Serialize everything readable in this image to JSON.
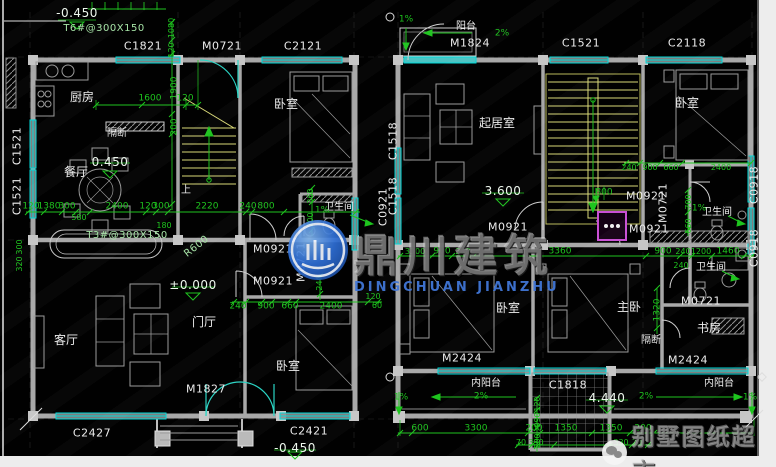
{
  "colors": {
    "dim_green": "#1ec41e",
    "window_cyan": "#00d9d9",
    "wall_gray": "#a8a8a8",
    "stair_yellow": "#d9d978",
    "shower_magenta": "#c94fd4",
    "watermark_blue": "#2f6fd6"
  },
  "watermarks": {
    "center_cn": "鼎川建筑",
    "center_en": "DINGCHUAN JIANZHU",
    "corner": "别墅图纸超市"
  },
  "labels": {
    "tags": [
      {
        "t": "C1821",
        "x": 143,
        "y": 46
      },
      {
        "t": "M0721",
        "x": 222,
        "y": 46
      },
      {
        "t": "C2121",
        "x": 303,
        "y": 46
      },
      {
        "t": "M1824",
        "x": 470,
        "y": 43
      },
      {
        "t": "C1521",
        "x": 581,
        "y": 43
      },
      {
        "t": "C2118",
        "x": 687,
        "y": 43
      },
      {
        "t": "C1521",
        "x": 17,
        "y": 146,
        "r": -90
      },
      {
        "t": "C1521",
        "x": 17,
        "y": 196,
        "r": -90
      },
      {
        "t": "C0921",
        "x": 383,
        "y": 207,
        "r": -90
      },
      {
        "t": "C1518",
        "x": 393,
        "y": 141,
        "r": -90
      },
      {
        "t": "C1518",
        "x": 393,
        "y": 196,
        "r": -90
      },
      {
        "t": "C0918",
        "x": 754,
        "y": 185,
        "r": -90
      },
      {
        "t": "C0918",
        "x": 754,
        "y": 248,
        "r": -90
      },
      {
        "t": "M0921",
        "x": 273,
        "y": 249
      },
      {
        "t": "M0921",
        "x": 273,
        "y": 281
      },
      {
        "t": "M0721",
        "x": 301,
        "y": 262,
        "r": -90
      },
      {
        "t": "M0921",
        "x": 508,
        "y": 227
      },
      {
        "t": "M0921",
        "x": 646,
        "y": 196
      },
      {
        "t": "M0921",
        "x": 649,
        "y": 229
      },
      {
        "t": "M0721",
        "x": 663,
        "y": 203,
        "r": -90
      },
      {
        "t": "M0721",
        "x": 701,
        "y": 301
      },
      {
        "t": "M1827",
        "x": 206,
        "y": 389
      },
      {
        "t": "C2427",
        "x": 92,
        "y": 433
      },
      {
        "t": "C2421",
        "x": 309,
        "y": 431
      },
      {
        "t": "M2424",
        "x": 462,
        "y": 358
      },
      {
        "t": "M2424",
        "x": 688,
        "y": 360
      },
      {
        "t": "C1818",
        "x": 568,
        "y": 385
      }
    ],
    "rooms": [
      {
        "t": "厨房",
        "x": 82,
        "y": 97
      },
      {
        "t": "隔断",
        "x": 117,
        "y": 134,
        "fs": 10
      },
      {
        "t": "餐厅",
        "x": 76,
        "y": 172
      },
      {
        "t": "卧室",
        "x": 286,
        "y": 104
      },
      {
        "t": "卫生间",
        "x": 339,
        "y": 208,
        "fs": 10
      },
      {
        "t": "客厅",
        "x": 66,
        "y": 340
      },
      {
        "t": "门厅",
        "x": 204,
        "y": 322
      },
      {
        "t": "卧室",
        "x": 288,
        "y": 366
      },
      {
        "t": "上",
        "x": 186,
        "y": 191,
        "fs": 10
      },
      {
        "t": "阳台",
        "x": 466,
        "y": 27,
        "fs": 10
      },
      {
        "t": "起居室",
        "x": 497,
        "y": 123
      },
      {
        "t": "卧室",
        "x": 687,
        "y": 103
      },
      {
        "t": "卫生间",
        "x": 717,
        "y": 213,
        "fs": 10
      },
      {
        "t": "卫生间",
        "x": 711,
        "y": 268,
        "fs": 10
      },
      {
        "t": "卧室",
        "x": 508,
        "y": 308
      },
      {
        "t": "主卧",
        "x": 629,
        "y": 307
      },
      {
        "t": "书房",
        "x": 709,
        "y": 328
      },
      {
        "t": "隔断",
        "x": 651,
        "y": 341,
        "fs": 10
      },
      {
        "t": "内阳台",
        "x": 486,
        "y": 384,
        "fs": 10
      },
      {
        "t": "内阳台",
        "x": 719,
        "y": 384,
        "fs": 10
      }
    ],
    "elevations": [
      {
        "t": "-0.450",
        "x": 77,
        "y": 13
      },
      {
        "t": "0.450",
        "x": 110,
        "y": 162
      },
      {
        "t": "±0.000",
        "x": 193,
        "y": 285
      },
      {
        "t": "3.600",
        "x": 503,
        "y": 191
      },
      {
        "t": "4.440",
        "x": 607,
        "y": 398
      },
      {
        "t": "-0.450",
        "x": 295,
        "y": 448
      }
    ],
    "notes": [
      {
        "t": "T6#@300X150",
        "x": 104,
        "y": 29
      },
      {
        "t": "T3#@300X150",
        "x": 127,
        "y": 236
      },
      {
        "t": "R600",
        "x": 197,
        "y": 247,
        "r": -38
      }
    ],
    "dims": [
      {
        "t": "1600",
        "x": 150,
        "y": 99
      },
      {
        "t": "120",
        "x": 185,
        "y": 99
      },
      {
        "t": "1080",
        "x": 172,
        "y": 28,
        "r": -90,
        "fs": 8
      },
      {
        "t": "120",
        "x": 172,
        "y": 50,
        "r": -90,
        "fs": 8
      },
      {
        "t": "1900",
        "x": 175,
        "y": 88,
        "r": -90
      },
      {
        "t": "200",
        "x": 175,
        "y": 127,
        "r": -90
      },
      {
        "t": "120",
        "x": 31,
        "y": 207
      },
      {
        "t": "1380",
        "x": 49,
        "y": 207
      },
      {
        "t": "300",
        "x": 67,
        "y": 207
      },
      {
        "t": "580",
        "x": 79,
        "y": 218,
        "fs": 8
      },
      {
        "t": "2400",
        "x": 117,
        "y": 207
      },
      {
        "t": "120",
        "x": 148,
        "y": 207
      },
      {
        "t": "300",
        "x": 161,
        "y": 207
      },
      {
        "t": "2220",
        "x": 207,
        "y": 207
      },
      {
        "t": "240",
        "x": 248,
        "y": 207
      },
      {
        "t": "800",
        "x": 266,
        "y": 207
      },
      {
        "t": "180",
        "x": 164,
        "y": 226,
        "fs": 8
      },
      {
        "t": "300",
        "x": 20,
        "y": 247,
        "r": -90,
        "fs": 8
      },
      {
        "t": "320",
        "x": 20,
        "y": 264,
        "r": -90,
        "fs": 8
      },
      {
        "t": "240",
        "x": 238,
        "y": 307
      },
      {
        "t": "900",
        "x": 266,
        "y": 307
      },
      {
        "t": "660",
        "x": 290,
        "y": 307
      },
      {
        "t": "2400",
        "x": 331,
        "y": 307
      },
      {
        "t": "120",
        "x": 373,
        "y": 297,
        "fs": 8
      },
      {
        "t": "60",
        "x": 377,
        "y": 306,
        "fs": 8
      },
      {
        "t": "240",
        "x": 320,
        "y": 283,
        "r": -90,
        "fs": 8
      },
      {
        "t": "360",
        "x": 311,
        "y": 196,
        "r": -90,
        "fs": 8
      },
      {
        "t": "700",
        "x": 311,
        "y": 220,
        "r": -90,
        "fs": 8
      },
      {
        "t": "1%",
        "x": 322,
        "y": 211
      },
      {
        "t": "1%",
        "x": 406,
        "y": 20
      },
      {
        "t": "2%",
        "x": 502,
        "y": 34
      },
      {
        "t": "800",
        "x": 604,
        "y": 193
      },
      {
        "t": "240",
        "x": 629,
        "y": 168,
        "fs": 8
      },
      {
        "t": "900",
        "x": 650,
        "y": 168,
        "fs": 8
      },
      {
        "t": "660",
        "x": 671,
        "y": 168,
        "fs": 8
      },
      {
        "t": "2400",
        "x": 721,
        "y": 168,
        "fs": 8
      },
      {
        "t": "3300",
        "x": 415,
        "y": 252,
        "fs": 8
      },
      {
        "t": "900",
        "x": 442,
        "y": 252
      },
      {
        "t": "240",
        "x": 463,
        "y": 252,
        "fs": 8
      },
      {
        "t": "3360",
        "x": 560,
        "y": 252
      },
      {
        "t": "900",
        "x": 663,
        "y": 252
      },
      {
        "t": "240",
        "x": 683,
        "y": 252,
        "fs": 8
      },
      {
        "t": "1200",
        "x": 701,
        "y": 252,
        "fs": 8
      },
      {
        "t": "1460",
        "x": 728,
        "y": 252
      },
      {
        "t": "240",
        "x": 681,
        "y": 266,
        "fs": 8
      },
      {
        "t": "1320",
        "x": 658,
        "y": 310,
        "r": -90
      },
      {
        "t": "700",
        "x": 689,
        "y": 202,
        "r": -90,
        "fs": 8
      },
      {
        "t": "660",
        "x": 689,
        "y": 226,
        "r": -90,
        "fs": 8
      },
      {
        "t": "1%",
        "x": 699,
        "y": 209
      },
      {
        "t": "2%",
        "x": 481,
        "y": 397
      },
      {
        "t": "2%",
        "x": 646,
        "y": 397
      },
      {
        "t": "1%",
        "x": 401,
        "y": 398
      },
      {
        "t": "1%",
        "x": 750,
        "y": 398
      },
      {
        "t": "600",
        "x": 420,
        "y": 429
      },
      {
        "t": "3300",
        "x": 476,
        "y": 429
      },
      {
        "t": "200",
        "x": 534,
        "y": 429
      },
      {
        "t": "1350",
        "x": 566,
        "y": 429
      },
      {
        "t": "1350",
        "x": 611,
        "y": 429
      },
      {
        "t": "200",
        "x": 643,
        "y": 429
      },
      {
        "t": "70",
        "x": 521,
        "y": 443,
        "fs": 8
      },
      {
        "t": "330",
        "x": 536,
        "y": 443,
        "fs": 8
      },
      {
        "t": "330",
        "x": 621,
        "y": 443,
        "fs": 8
      },
      {
        "t": "70",
        "x": 637,
        "y": 443,
        "fs": 8
      },
      {
        "t": "120",
        "x": 538,
        "y": 404,
        "r": -90,
        "fs": 8
      },
      {
        "t": "990",
        "x": 538,
        "y": 420,
        "r": -90,
        "fs": 8
      },
      {
        "t": "200",
        "x": 538,
        "y": 441,
        "r": -90,
        "fs": 8
      }
    ]
  }
}
